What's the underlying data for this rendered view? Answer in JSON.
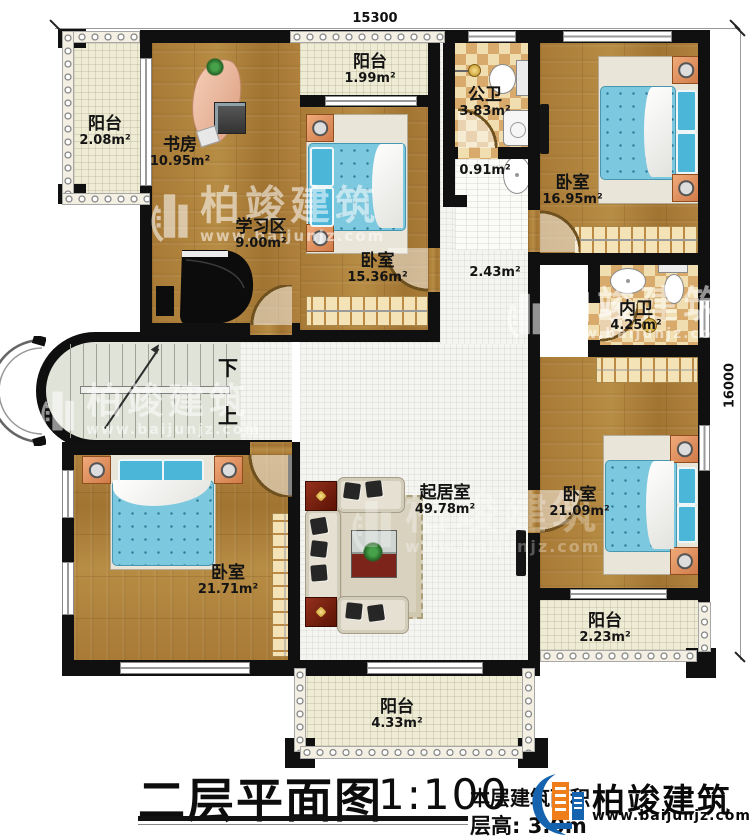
{
  "dimensions": {
    "top": "15300",
    "right": "16000"
  },
  "rooms": {
    "balcony_tl": {
      "name": "阳台",
      "area": "2.08m²"
    },
    "study": {
      "name": "书房",
      "area": "10.95m²"
    },
    "study_area": {
      "name": "学习区",
      "area": "9.00m²"
    },
    "balcony_top": {
      "name": "阳台",
      "area": "1.99m²"
    },
    "bedroom_mid": {
      "name": "卧室",
      "area": "15.36m²"
    },
    "public_bath": {
      "name": "公卫",
      "area": "3.83m²"
    },
    "wash_nook": {
      "area": "0.91m²"
    },
    "bedroom_tr": {
      "name": "卧室",
      "area": "16.95m²"
    },
    "corridor": {
      "area": "2.43m²"
    },
    "inner_bath": {
      "name": "内卫",
      "area": "4.25m²"
    },
    "bedroom_br": {
      "name": "卧室",
      "area": "21.09m²"
    },
    "living": {
      "name": "起居室",
      "area": "49.78m²"
    },
    "bedroom_bl": {
      "name": "卧室",
      "area": "21.71m²"
    },
    "balcony_bottom": {
      "name": "阳台",
      "area": "4.33m²"
    },
    "balcony_br": {
      "name": "阳台",
      "area": "2.23m²"
    }
  },
  "stairs": {
    "down": "下",
    "up": "上"
  },
  "title": {
    "main": "二层平面图",
    "scale": "1:100",
    "area_line": "本层建筑面积",
    "floor_height": "层高: 3.0m"
  },
  "brand": {
    "name": "柏竣建筑",
    "url": "www.baijunjz.com"
  },
  "watermark": {
    "name": "柏竣建筑",
    "url": "www.baijunjz.com"
  },
  "colors": {
    "wall": "#101010",
    "wood": "#ab7d3a",
    "bath_tile": "#d8ab6c",
    "bed": "#7cc8de",
    "brand_blue": "#1563ae",
    "brand_orange": "#ef7d1a"
  }
}
